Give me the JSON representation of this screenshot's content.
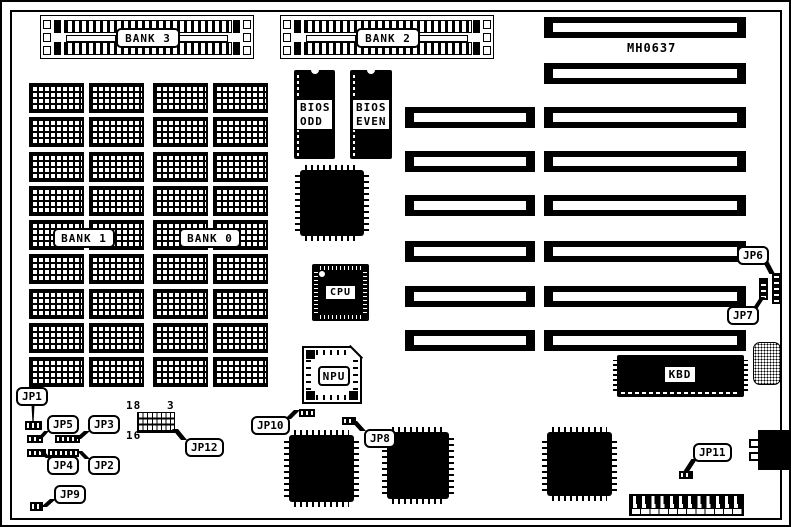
{
  "colors": {
    "ink": "#000000",
    "paper": "#ffffff"
  },
  "part_number": "MH0637",
  "simm_sockets": [
    {
      "label": "BANK 3"
    },
    {
      "label": "BANK 2"
    }
  ],
  "dram_banks": [
    {
      "label": "BANK 1"
    },
    {
      "label": "BANK 0"
    }
  ],
  "dram_grid": {
    "rows": 9,
    "columns": 4
  },
  "chips": {
    "bios_odd": {
      "line1": "BIOS",
      "line2": "ODD"
    },
    "bios_even": {
      "line1": "BIOS",
      "line2": "EVEN"
    },
    "cpu": {
      "label": "CPU"
    },
    "npu": {
      "label": "NPU"
    },
    "kbd": {
      "label": "KBD"
    }
  },
  "jumpers": [
    {
      "label": "JP1"
    },
    {
      "label": "JP2"
    },
    {
      "label": "JP3"
    },
    {
      "label": "JP4"
    },
    {
      "label": "JP5"
    },
    {
      "label": "JP6"
    },
    {
      "label": "JP7"
    },
    {
      "label": "JP8"
    },
    {
      "label": "JP9"
    },
    {
      "label": "JP10"
    },
    {
      "label": "JP11"
    },
    {
      "label": "JP12"
    }
  ],
  "jp12_header_pins": {
    "top_left": "18",
    "top_right": "3",
    "bottom_left": "16"
  },
  "expansion_slots": {
    "eight_bit_count": 2,
    "sixteen_bit_count": 6
  }
}
